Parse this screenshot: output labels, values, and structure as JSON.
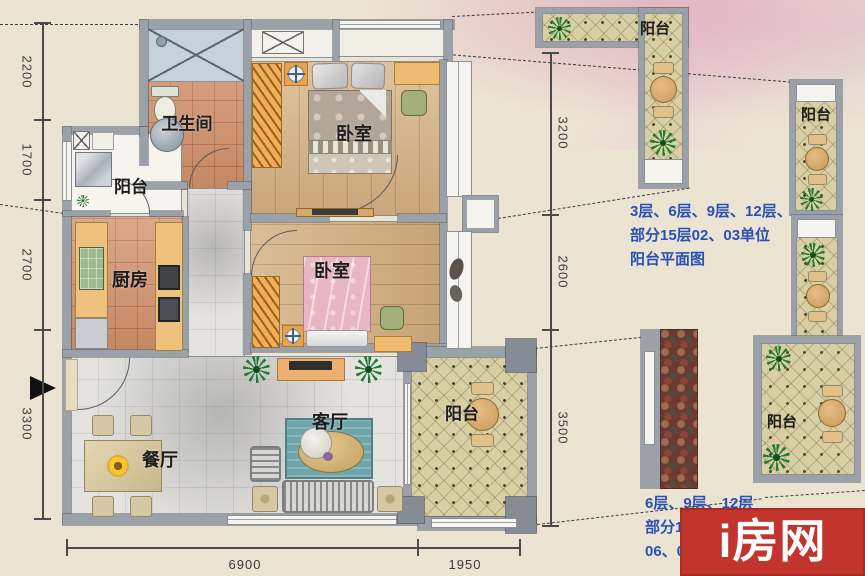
{
  "plan": {
    "rooms": {
      "bathroom": "卫生间",
      "balcony_service": "阳台",
      "kitchen": "厨房",
      "bedroom_main": "卧室",
      "bedroom_second": "卧室",
      "living": "客厅",
      "dining": "餐厅",
      "balcony_living": "阳台"
    },
    "dimensions": {
      "left": [
        "2200",
        "1700",
        "2700",
        "3300"
      ],
      "bottom": [
        "6900",
        "1950"
      ],
      "right": [
        "3200",
        "2600",
        "3500"
      ]
    }
  },
  "details": {
    "balcony_top_label": "阳台",
    "balcony_right_label": "阳台",
    "balcony_bottom_label": "阳台",
    "note_top_line1": "3层、6层、9层、12层、",
    "note_top_line2": "部分15层02、03单位",
    "note_top_line3": "阳台平面图",
    "note_bottom_line1": "6层、9层、12层",
    "note_bottom_line2": "部分15层",
    "note_bottom_line3": "06、07"
  },
  "watermark": {
    "text": "i房网"
  },
  "colors": {
    "note_blue": "#2b50b5",
    "watermark_red": "#c2352c",
    "wall_gray": "#9ba1a9",
    "wood_floor": "#d8b68a",
    "terracotta_tile": "#d2906a",
    "balcony_tile": "#d9cfa5"
  }
}
